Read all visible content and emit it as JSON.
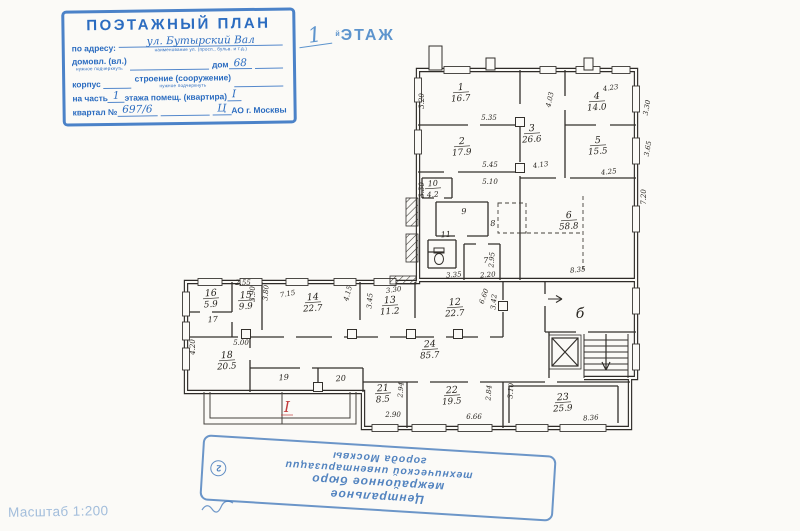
{
  "header_stamp": {
    "title": "ПОЭТАЖНЫЙ ПЛАН",
    "address_label": "по адресу:",
    "address_value": "ул. Бутырский Вал",
    "address_sub": "наименование ул. (просп., бульв. и т.д.)",
    "line2_label1": "домовл. (вл.)",
    "line2_sub": "нужное подчеркнуть",
    "line2_label2": "дом",
    "line2_value": "68",
    "line3_label1": "корпус",
    "line3_label2": "строение (сооружение)",
    "line3_sub": "нужное подчеркнуть",
    "line4_label1": "на часть",
    "line4_value1": "1",
    "line4_label2": "этажа помещ. (квартира)",
    "line4_value2": "I",
    "line5_label1": "квартал №",
    "line5_value1": "697/6",
    "line5_value2": "Ц",
    "line5_label2": "АО г. Москвы"
  },
  "floor_title": {
    "number": "1",
    "suffix": "й",
    "word": "ЭТАЖ"
  },
  "scale_note": "Масштаб 1:200",
  "bottom_stamp": {
    "lines": [
      "Центральное",
      "межрайонное бюро",
      "технической инвентаризации",
      "города Москвы"
    ],
    "number": "2"
  },
  "floor_plan": {
    "room_labels": [
      {
        "num": "1",
        "area": "16.7",
        "x": 461,
        "y": 90
      },
      {
        "num": "2",
        "area": "17.9",
        "x": 462,
        "y": 144
      },
      {
        "num": "3",
        "area": "26.6",
        "x": 532,
        "y": 131
      },
      {
        "num": "4",
        "area": "14.0",
        "x": 597,
        "y": 99
      },
      {
        "num": "5",
        "area": "15.5",
        "x": 598,
        "y": 143
      },
      {
        "num": "6",
        "area": "58.8",
        "x": 569,
        "y": 218
      },
      {
        "num": "7",
        "x": 486,
        "y": 263,
        "small": true
      },
      {
        "num": "8",
        "x": 493,
        "y": 226,
        "small": true
      },
      {
        "num": "9",
        "x": 464,
        "y": 214,
        "small": true
      },
      {
        "num": "10",
        "area": "4.2",
        "x": 433,
        "y": 186,
        "small": true
      },
      {
        "num": "11",
        "x": 446,
        "y": 237,
        "small": true
      },
      {
        "num": "12",
        "area": "22.7",
        "x": 455,
        "y": 305
      },
      {
        "num": "13",
        "area": "11.2",
        "x": 390,
        "y": 303
      },
      {
        "num": "14",
        "area": "22.7",
        "x": 313,
        "y": 300
      },
      {
        "num": "15",
        "area": "9.9",
        "x": 246,
        "y": 298
      },
      {
        "num": "16",
        "area": "5.9",
        "x": 211,
        "y": 296
      },
      {
        "num": "17",
        "x": 213,
        "y": 322,
        "small": true
      },
      {
        "num": "18",
        "area": "20.5",
        "x": 227,
        "y": 358
      },
      {
        "num": "19",
        "x": 284,
        "y": 380,
        "small": true
      },
      {
        "num": "20",
        "x": 341,
        "y": 381,
        "small": true
      },
      {
        "num": "21",
        "area": "8.5",
        "x": 383,
        "y": 391
      },
      {
        "num": "22",
        "area": "19.5",
        "x": 452,
        "y": 393
      },
      {
        "num": "23",
        "area": "25.9",
        "x": 563,
        "y": 400
      },
      {
        "num": "24",
        "area": "85.7",
        "x": 430,
        "y": 347
      }
    ],
    "zone_labels": [
      {
        "text": "б",
        "x": 580,
        "y": 318
      }
    ],
    "marks": [
      {
        "text": "I",
        "x": 287,
        "y": 412,
        "color": "#c23b3b"
      }
    ],
    "dimensions": [
      {
        "t": "3.20",
        "x": 424,
        "y": 101,
        "r": -90
      },
      {
        "t": "3.30",
        "x": 424,
        "y": 190,
        "r": -90
      },
      {
        "t": "5.35",
        "x": 489,
        "y": 120
      },
      {
        "t": "5.45",
        "x": 490,
        "y": 167
      },
      {
        "t": "5.10",
        "x": 490,
        "y": 184
      },
      {
        "t": "4.13",
        "x": 541,
        "y": 167,
        "r": -8
      },
      {
        "t": "4.03",
        "x": 552,
        "y": 100,
        "r": -78
      },
      {
        "t": "4.23",
        "x": 611,
        "y": 90,
        "r": -8
      },
      {
        "t": "3.30",
        "x": 649,
        "y": 108,
        "r": -80
      },
      {
        "t": "3.65",
        "x": 650,
        "y": 149,
        "r": -80
      },
      {
        "t": "4.25",
        "x": 609,
        "y": 174,
        "r": -6
      },
      {
        "t": "7.20",
        "x": 646,
        "y": 197,
        "r": -90
      },
      {
        "t": "8.35",
        "x": 578,
        "y": 272,
        "r": -6
      },
      {
        "t": "2.95",
        "x": 494,
        "y": 260,
        "r": -85
      },
      {
        "t": "3.35",
        "x": 454,
        "y": 277,
        "r": -5
      },
      {
        "t": "2.20",
        "x": 488,
        "y": 277,
        "r": -5
      },
      {
        "t": "2.55",
        "x": 243,
        "y": 285
      },
      {
        "t": "3.90",
        "x": 255,
        "y": 294,
        "r": -90
      },
      {
        "t": "3.80",
        "x": 268,
        "y": 293,
        "r": -85
      },
      {
        "t": "7.15",
        "x": 288,
        "y": 296,
        "r": -10
      },
      {
        "t": "4.15",
        "x": 350,
        "y": 294,
        "r": -75
      },
      {
        "t": "3.45",
        "x": 372,
        "y": 301,
        "r": -85
      },
      {
        "t": "3.30",
        "x": 394,
        "y": 292,
        "r": -8
      },
      {
        "t": "6.60",
        "x": 486,
        "y": 297,
        "r": -70
      },
      {
        "t": "3.42",
        "x": 496,
        "y": 302,
        "r": -85
      },
      {
        "t": "4.20",
        "x": 195,
        "y": 347,
        "r": -90
      },
      {
        "t": "5.00",
        "x": 241,
        "y": 345
      },
      {
        "t": "2.94",
        "x": 403,
        "y": 390,
        "r": -85
      },
      {
        "t": "2.90",
        "x": 393,
        "y": 417
      },
      {
        "t": "2.84",
        "x": 491,
        "y": 393,
        "r": -85
      },
      {
        "t": "3.10",
        "x": 513,
        "y": 391,
        "r": -85
      },
      {
        "t": "6.66",
        "x": 474,
        "y": 419
      },
      {
        "t": "8.36",
        "x": 591,
        "y": 420,
        "r": -5
      }
    ]
  }
}
